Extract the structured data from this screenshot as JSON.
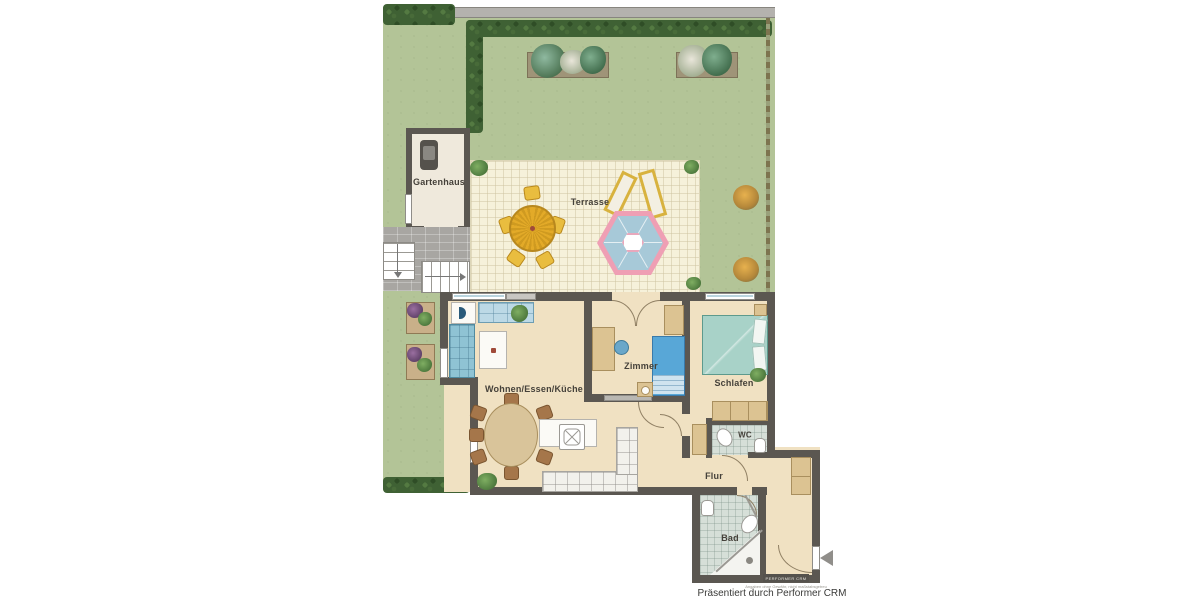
{
  "plan": {
    "rooms": {
      "gartenhaus": "Gartenhaus",
      "terrasse": "Terrasse",
      "wohnen": "Wohnen/Essen/Küche",
      "zimmer": "Zimmer",
      "schlafen": "Schlafen",
      "wc": "WC",
      "flur": "Flur",
      "bad": "Bad"
    },
    "footer": {
      "watermark": "PERFORMER CRM",
      "disclaimer": "Angaben ohne Gewähr, nicht maßstabsgetreu",
      "credit": "Präsentiert durch Performer CRM"
    },
    "colors": {
      "wall": "#5b5751",
      "floor": "#f0e1c2",
      "grass": "#b3c497",
      "terrace": "#f6f1da",
      "hedge": "#3f6134",
      "tiles": "#d6dfd8",
      "single_bed": "#58a7d7",
      "double_bed": "#a8d2c8",
      "pavilion_pink": "#ef9fb4",
      "pavilion_blue": "#a7c9d8",
      "garden_table": "#e3aa28",
      "wood_furniture": "#dcc392"
    }
  }
}
